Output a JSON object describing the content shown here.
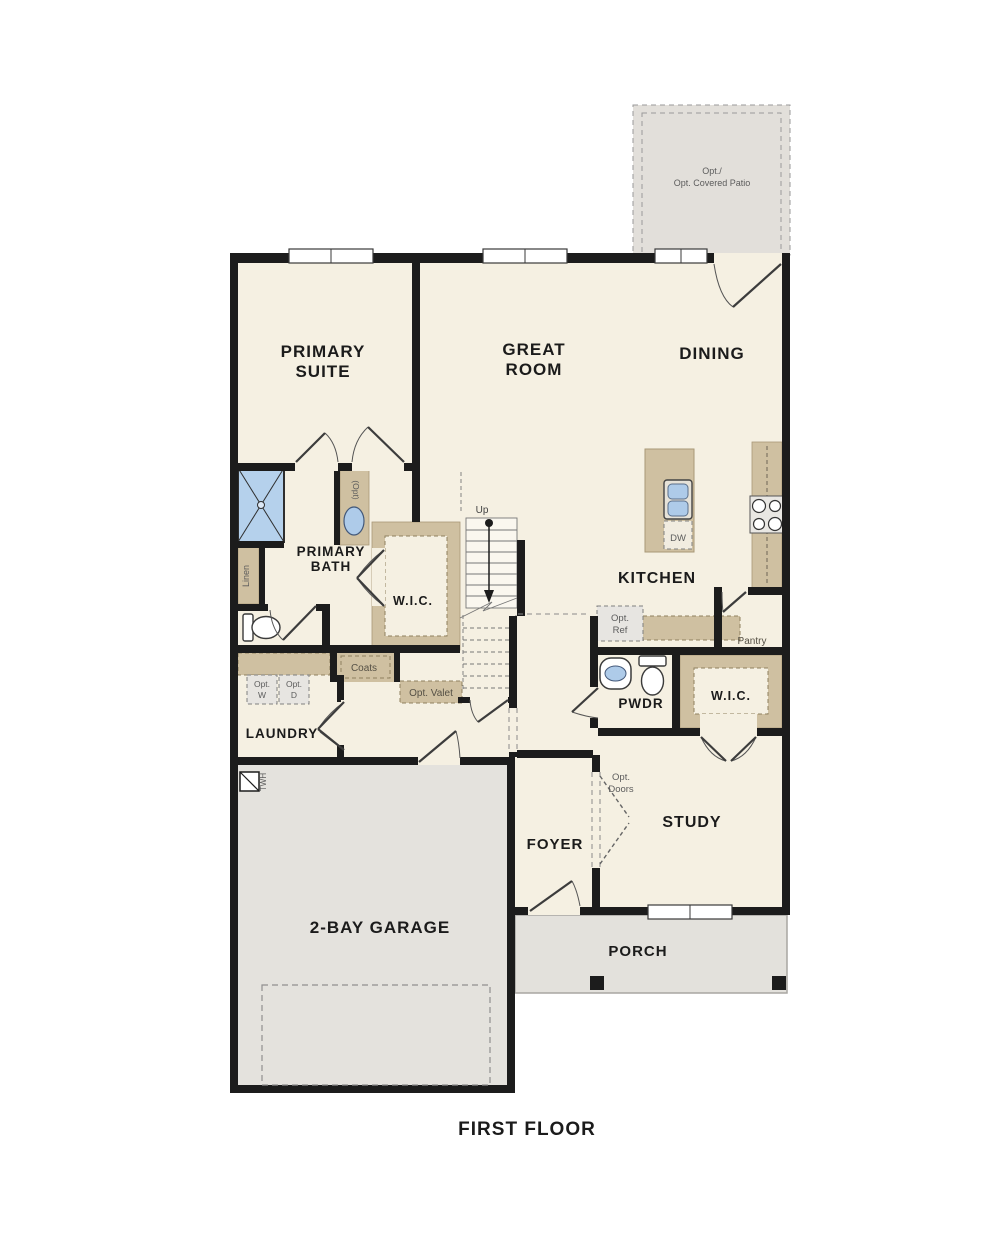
{
  "title": "FIRST FLOOR",
  "colors": {
    "floor_cream": "#f5f0e2",
    "wall_black": "#1c1c1c",
    "cabinet_tan": "#cfc0a1",
    "area_gray": "#e4e1dc",
    "fixture_blue": "#aecbe9",
    "dashed_gray": "#8a8a8a",
    "annotation_text": "#5c5c5c"
  },
  "labels": {
    "patio": {
      "line1": "Opt./",
      "line2": "Opt. Covered Patio"
    },
    "primary_suite": {
      "line1": "PRIMARY",
      "line2": "SUITE"
    },
    "great_room": {
      "line1": "GREAT",
      "line2": "ROOM"
    },
    "dining": "DINING",
    "kitchen": "KITCHEN",
    "primary_bath": {
      "line1": "PRIMARY",
      "line2": "BATH"
    },
    "wic_primary": "W.I.C.",
    "wic_study": "W.I.C.",
    "pwdr": "PWDR",
    "laundry": "LAUNDRY",
    "foyer": "FOYER",
    "study": "STUDY",
    "garage": "2-BAY GARAGE",
    "porch": "PORCH",
    "pantry": "Pantry",
    "coats": "Coats",
    "linen": "Linen",
    "up": "Up",
    "opt_vanity": "(Opt)",
    "dw": "DW",
    "twh": "TWH",
    "opt_valet": "Opt. Valet",
    "opt_w": {
      "line1": "Opt.",
      "line2": "W"
    },
    "opt_d": {
      "line1": "Opt.",
      "line2": "D"
    },
    "opt_ref": {
      "line1": "Opt.",
      "line2": "Ref"
    },
    "opt_doors": {
      "line1": "Opt.",
      "line2": "Doors"
    },
    "title": "FIRST FLOOR"
  }
}
